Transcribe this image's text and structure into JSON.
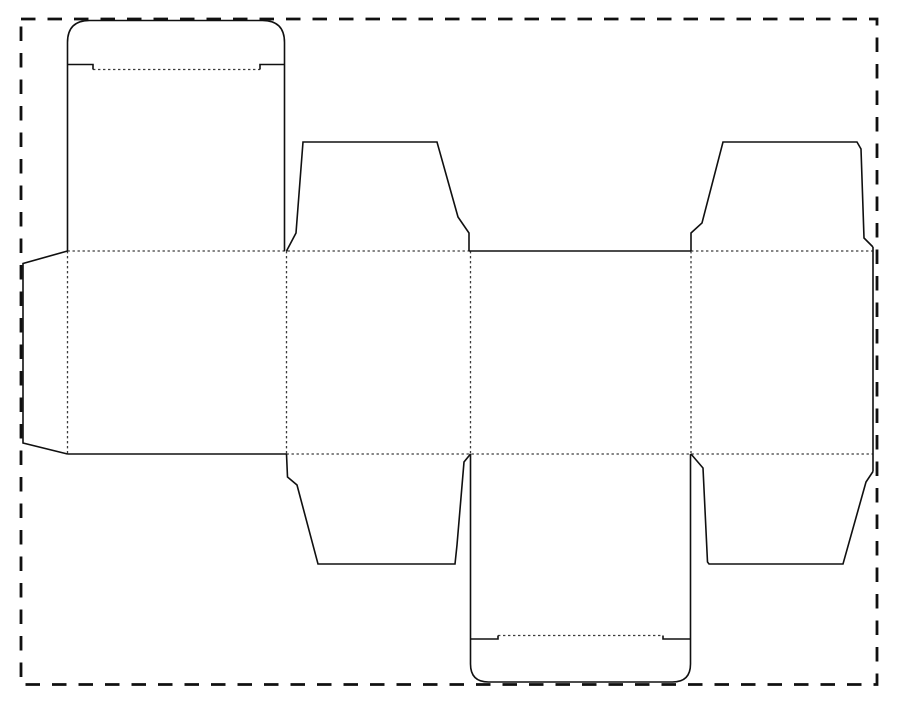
{
  "title": "Folding carton box dieline template (unfolded tuck-end box blank)",
  "canvas": {
    "width": 900,
    "height": 708,
    "background": "#ffffff"
  },
  "legend": {
    "cut_line_meaning": "solid black line = cut",
    "fold_line_meaning": "dotted gray line = fold / crease",
    "border_meaning": "dashed line = sheet boundary"
  },
  "line_styles": {
    "cut": {
      "color": "#101010",
      "width": 1.6
    },
    "fold": {
      "color": "#3c3c3c",
      "width": 1.3,
      "dash": "2.4 2.6"
    },
    "page_border": {
      "color": "#101010",
      "width": 2.8,
      "dash": "14.5 12"
    }
  },
  "page_border": {
    "x": 21,
    "y": 19,
    "width": 856,
    "height": 665.5
  },
  "cut_lines": [
    {
      "name": "glue-flap-edge",
      "d": "M 67.5 251 L 23 263.5 L 23 443 L 67.5 454"
    },
    {
      "name": "lid-panel-and-tuck-outline",
      "d": "M 67.5 251 L 67.5 42.5 Q 67.5 20.5 89.5 20.5 L 262.5 20.5 Q 284.5 20.5 284.5 42.5 L 284.5 251"
    },
    {
      "name": "top-tuck-left-shoulder",
      "d": "M 67.5 64.5 L 93 64.5 L 93 69.5"
    },
    {
      "name": "top-tuck-right-shoulder",
      "d": "M 284.5 64.5 L 260 64.5 L 260 69.5"
    },
    {
      "name": "top-dust-flap-left-outline",
      "d": "M 286.5 251 L 296 233 L 303 142 L 437 142 L 458 217 L 469 233 L 469 251"
    },
    {
      "name": "back-panel-top-edge",
      "d": "M 469 251 L 691 251"
    },
    {
      "name": "top-dust-flap-right-outline",
      "d": "M 691 251 L 691 233 L 702 223 L 723 142 L 857 142 L 861 149 L 864 238 L 873 247"
    },
    {
      "name": "right-panel-outer-edge",
      "d": "M 873 247 L 873 471.5"
    },
    {
      "name": "bottom-dust-flap-right-outline",
      "d": "M 873 471.5 L 866 482 L 843 564 L 709 564 L 707.5 562 L 703 468 L 691 454"
    },
    {
      "name": "front-panel-bottom-edge",
      "d": "M 67.5 454 L 286.5 454"
    },
    {
      "name": "bottom-dust-flap-left-outline",
      "d": "M 286.5 454 L 287.5 477 L 297 485 L 318 564 L 455 564 L 457 545 L 464 462 L 470.5 454"
    },
    {
      "name": "bottom-panel-and-tuck-outline",
      "d": "M 470.5 454 L 470.5 664 Q 470.5 682 488.5 682 L 672.5 682 Q 690.5 682 690.5 664 L 690.5 454"
    },
    {
      "name": "bottom-tuck-left-shoulder",
      "d": "M 470.5 639 L 498 639 L 498 635.5"
    },
    {
      "name": "bottom-tuck-right-shoulder",
      "d": "M 690.5 639 L 663 639 L 663 635.5"
    }
  ],
  "fold_lines": [
    {
      "name": "top-tuck-fold",
      "d": "M 93 69.5 L 260 69.5"
    },
    {
      "name": "top-body-fold-left",
      "d": "M 67.5 251 L 469 251"
    },
    {
      "name": "top-body-fold-right",
      "d": "M 691 251 L 873 251"
    },
    {
      "name": "bottom-body-fold",
      "d": "M 286.5 454 L 873 454"
    },
    {
      "name": "glue-flap-fold",
      "d": "M 67.5 251 L 67.5 454"
    },
    {
      "name": "panel-fold-1-2",
      "d": "M 286.5 251 L 286.5 454"
    },
    {
      "name": "panel-fold-2-3",
      "d": "M 470.5 251 L 470.5 454"
    },
    {
      "name": "panel-fold-3-4",
      "d": "M 691 251 L 691 454"
    },
    {
      "name": "bottom-tuck-fold",
      "d": "M 498 635.5 L 663 635.5"
    }
  ]
}
